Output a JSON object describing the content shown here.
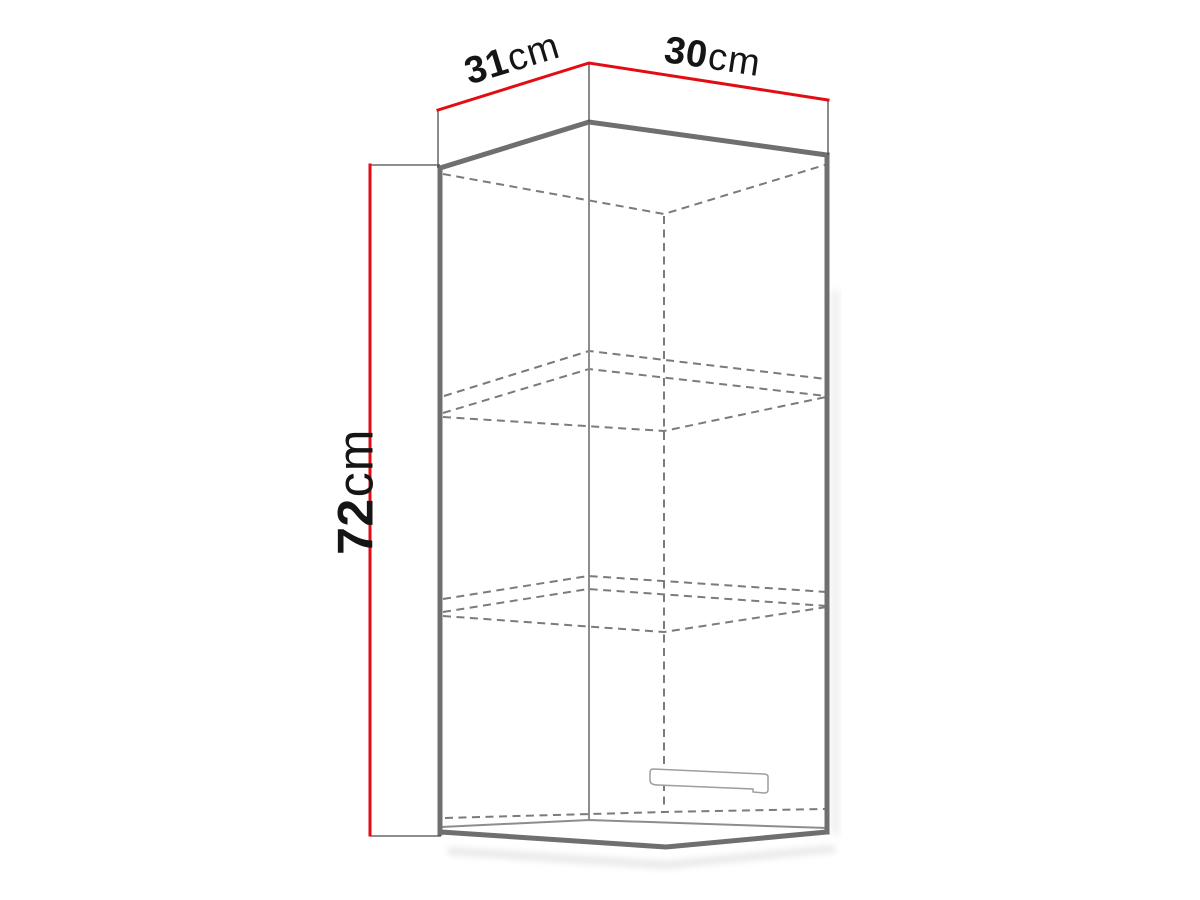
{
  "dimensions": {
    "top_left": {
      "value": "31",
      "unit": "cm"
    },
    "top_right": {
      "value": "30",
      "unit": "cm"
    },
    "height": {
      "value": "72",
      "unit": "cm"
    }
  },
  "colors": {
    "dimension_line": "#e20d13",
    "cabinet_edge": "#6f6f6f",
    "hidden_edge": "#7b7b7b",
    "inner_edge": "#8d8d8d",
    "extension_line": "#4a4a4a",
    "handle_outline": "#9e9e9e",
    "label_text": "#151515",
    "background": "#ffffff"
  }
}
